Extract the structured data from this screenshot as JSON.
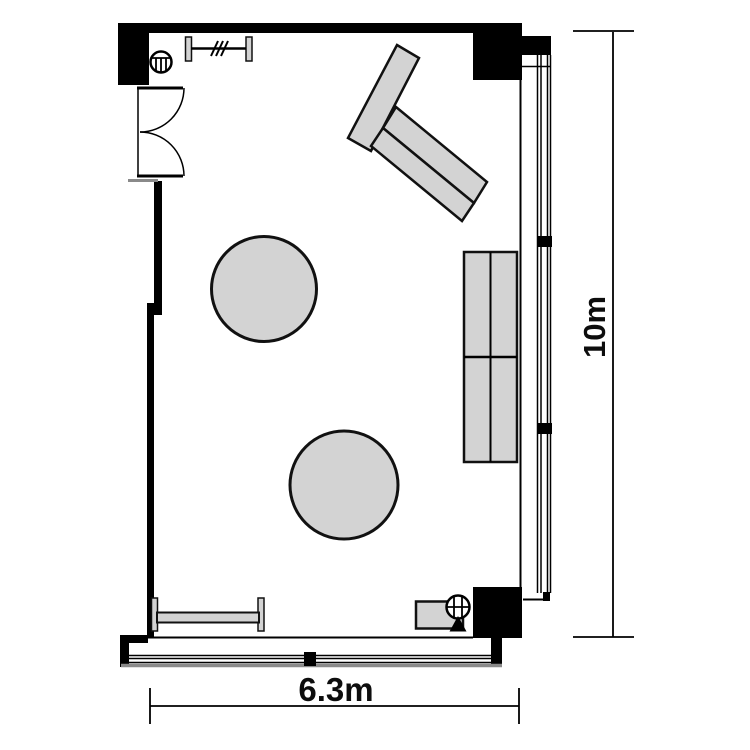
{
  "floorplan": {
    "title": "room-floor-plan",
    "width_label": "6.3m",
    "height_label": "10m",
    "room": {
      "width_m": 6.3,
      "height_m": 10
    },
    "colors": {
      "background": "#ffffff",
      "wall": "#000000",
      "furniture_fill": "#d3d3d3",
      "furniture_stroke": "#111111",
      "line": "#000000",
      "sill": "#8a8a8a"
    },
    "icons": {
      "door": "double-swing-door-icon",
      "coat_rack": "coat-rack-icon",
      "circular_fixture_top_left": "circular-fixture-icon",
      "circular_fixture_bottom_right": "circular-fixture-icon",
      "triangle_marker": "triangle-marker-icon"
    },
    "elements": [
      "double-swing-entrance-door",
      "coat-rack",
      "angled-table-set",
      "round-table-1",
      "round-table-2",
      "side-table-block",
      "bench",
      "low-cabinet",
      "full-height-window-right",
      "window-bottom",
      "column-top-left",
      "column-top-right",
      "column-bottom-right"
    ]
  }
}
